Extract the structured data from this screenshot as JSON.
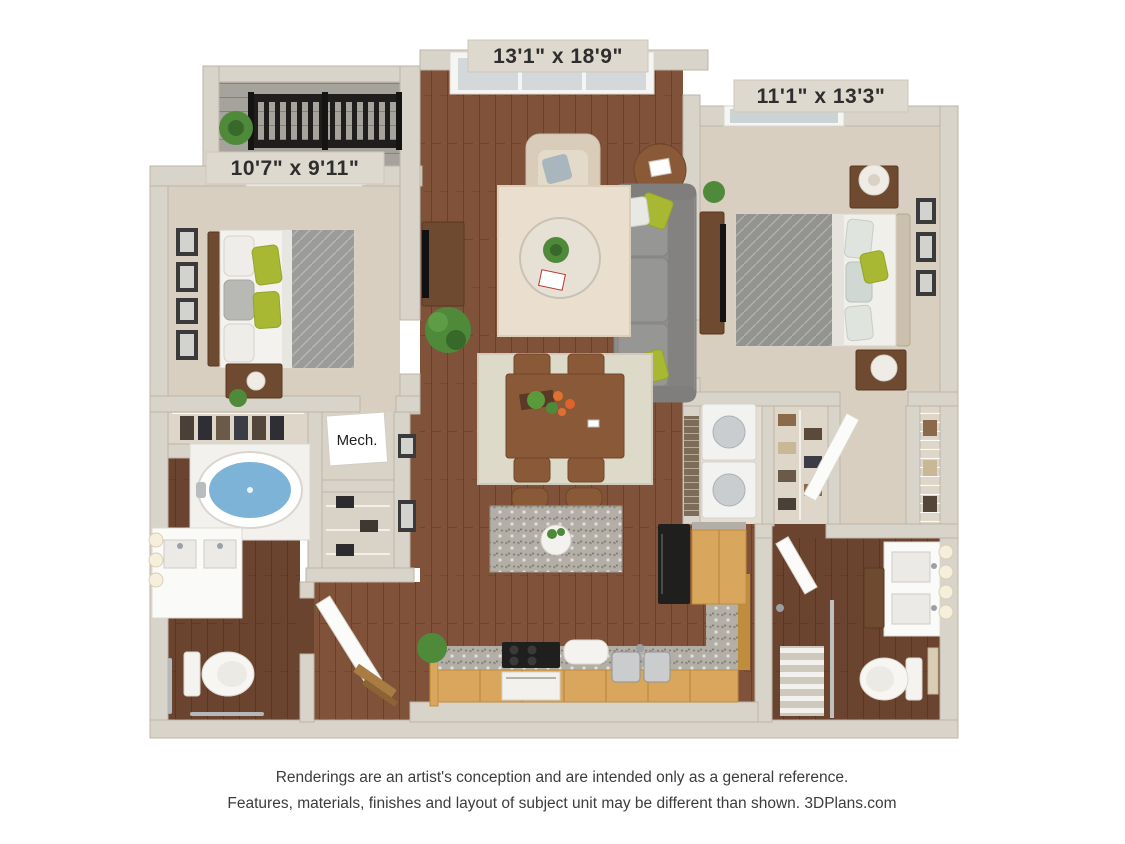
{
  "labels": {
    "living_dims": "13'1\" x 18'9\"",
    "bedroom_right_dims": "11'1\" x 13'3\"",
    "bedroom_left_dims": "10'7\" x 9'11\"",
    "mech": "Mech."
  },
  "disclaimer": {
    "line1": "Renderings are an artist's conception and are intended only as a general reference.",
    "line2": "Features, materials, finishes and layout of subject unit may be different than shown. 3DPlans.com"
  },
  "colors": {
    "background": "#ffffff",
    "wall": "#d9d4ca",
    "wall_shadow": "#bdb5a7",
    "wood_floor": "#80523a",
    "wood_floor_dark": "#6b4430",
    "carpet": "#d8cfc0",
    "balcony_deck": "#a6a39d",
    "railing": "#1f1e1c",
    "rug_living": "#eadfce",
    "rug_dining": "#dedac9",
    "sofa": "#8e8d8b",
    "armchair": "#d9cdba",
    "accent_green": "#a9b832",
    "tub_water": "#7db3d6",
    "cabinet_tan": "#d8a65c",
    "granite": "#b3afa7",
    "appliance_black": "#1f1f1d",
    "plant_green": "#4e8a3a",
    "table_wood": "#8a5a38",
    "text_dark": "#2e2e2e"
  }
}
